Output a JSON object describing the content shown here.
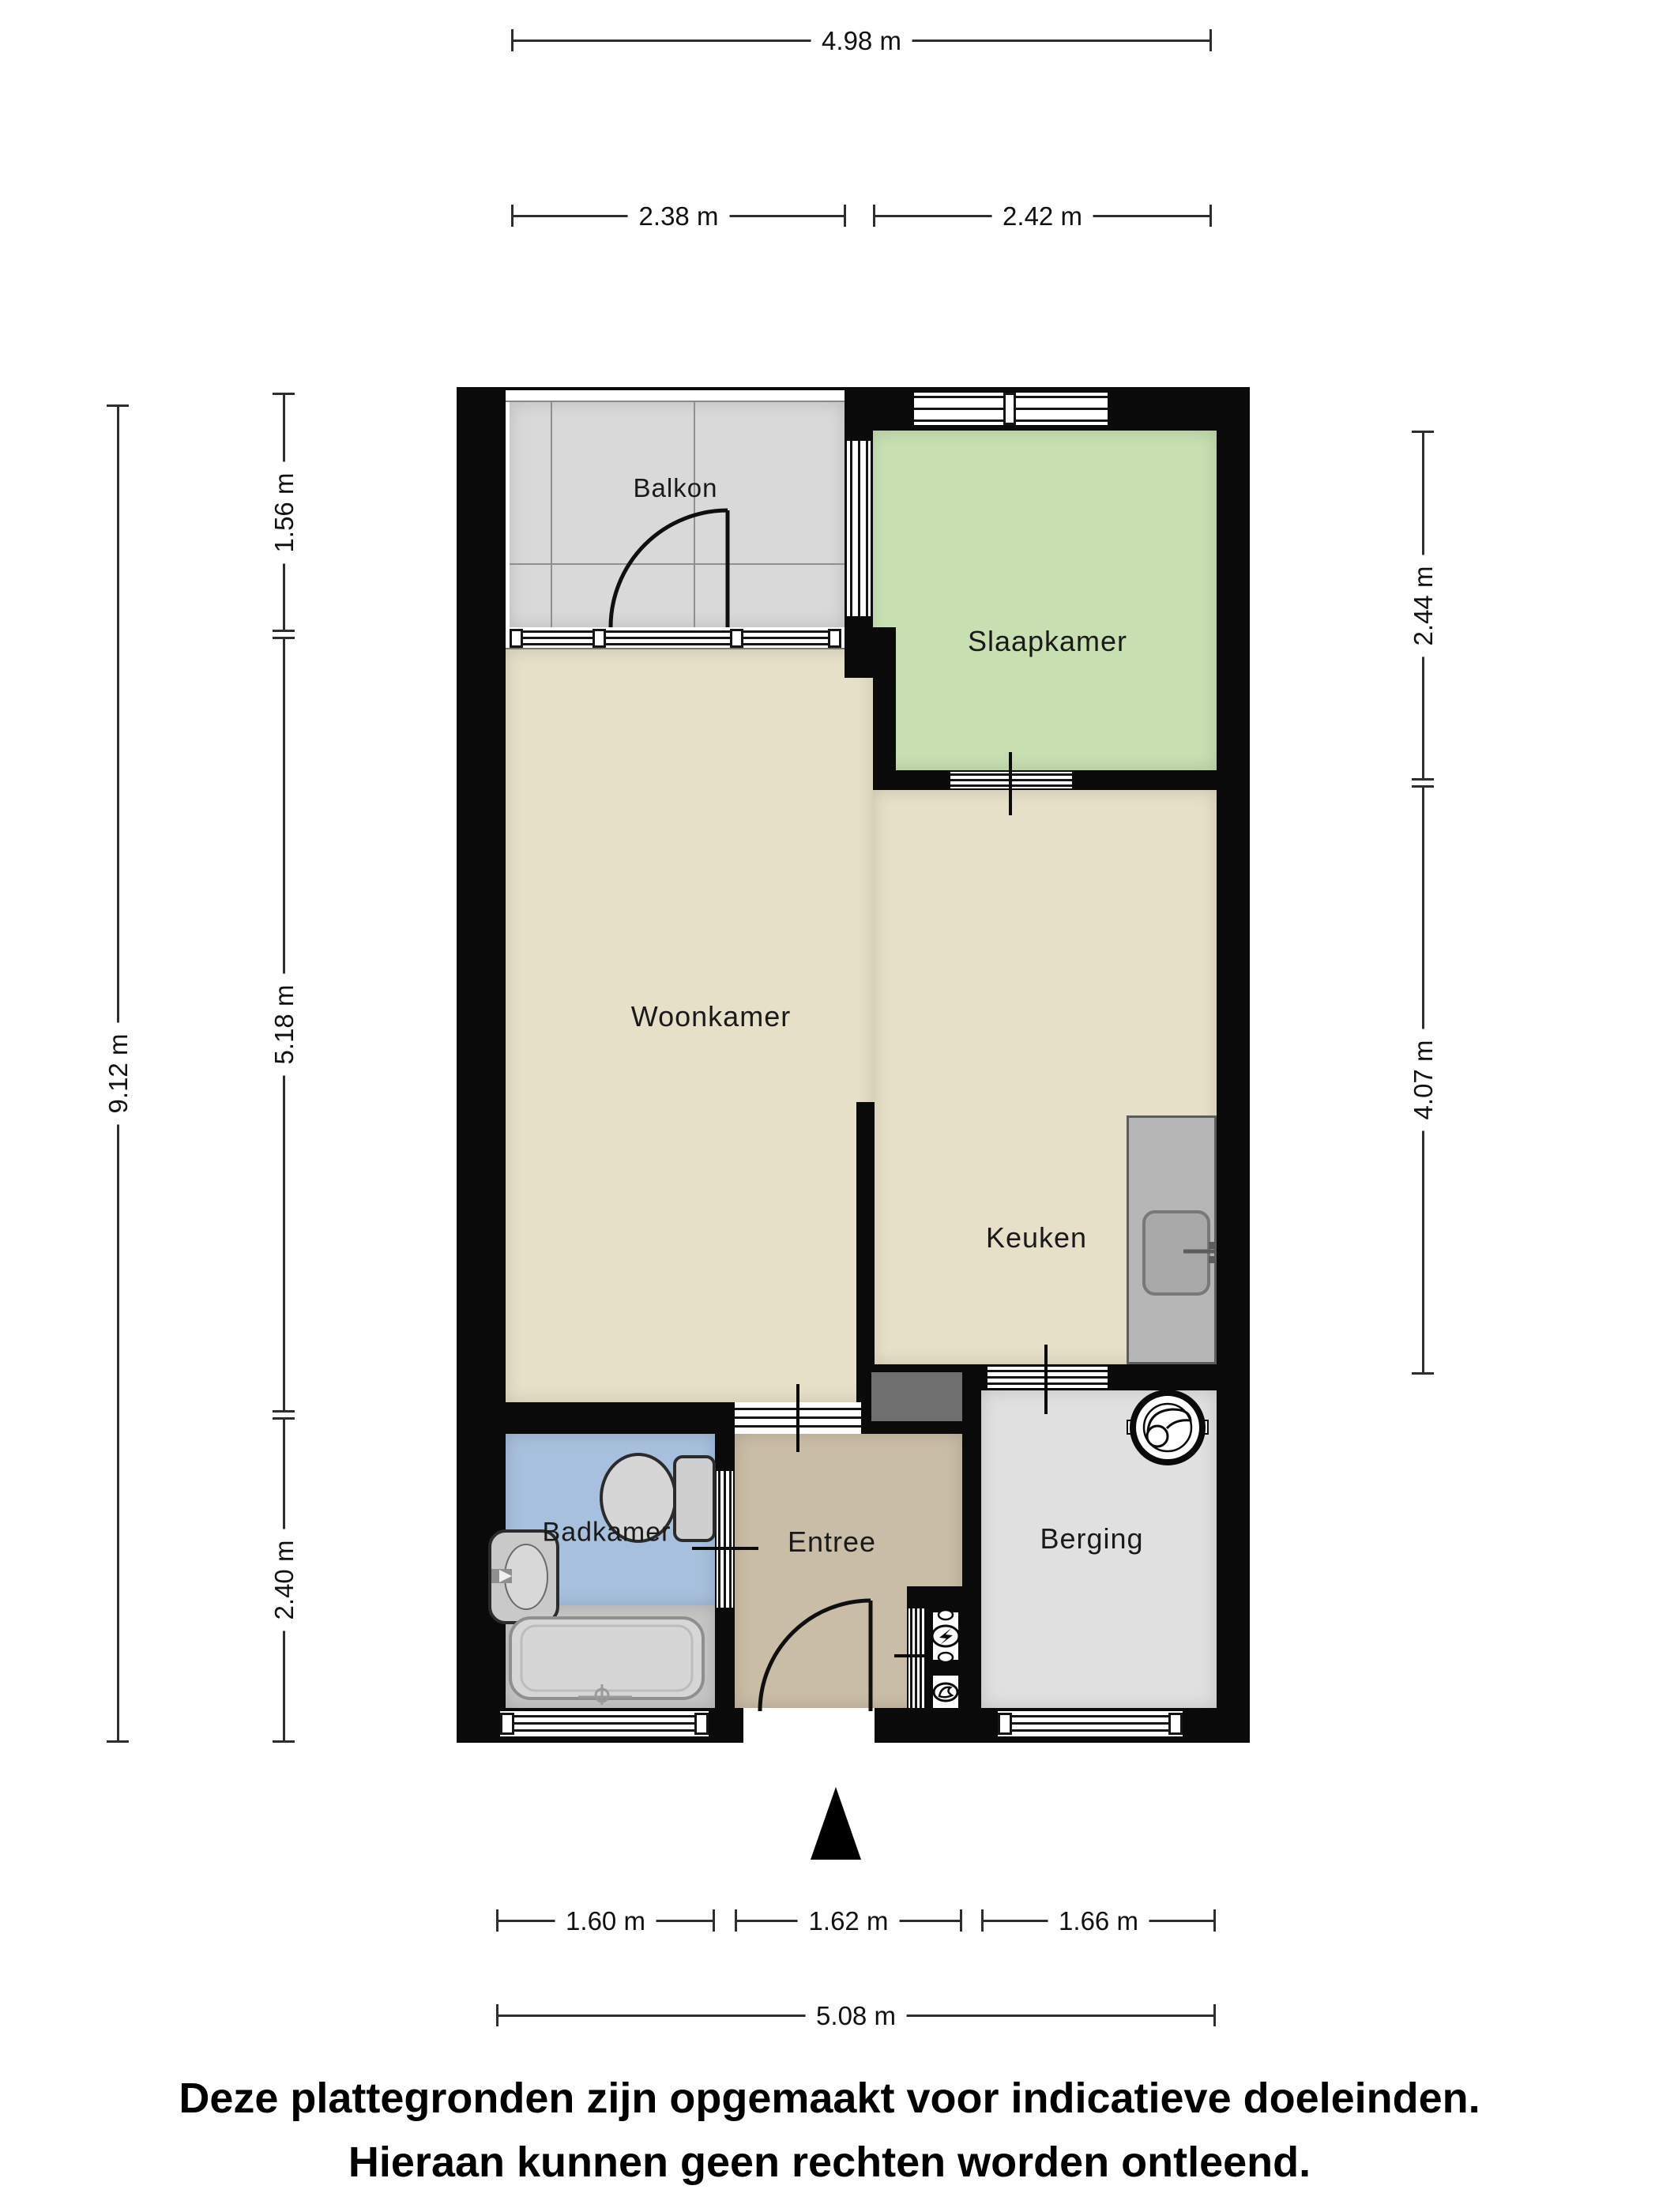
{
  "rooms": {
    "balkon": "Balkon",
    "slaapkamer": "Slaapkamer",
    "woonkamer": "Woonkamer",
    "keuken": "Keuken",
    "badkamer": "Badkamer",
    "entree": "Entree",
    "berging": "Berging"
  },
  "dimensions": {
    "top_total": "4.98 m",
    "top_left": "2.38 m",
    "top_right": "2.42 m",
    "left_total": "9.12 m",
    "left_top": "1.56 m",
    "left_mid": "5.18 m",
    "left_bottom": "2.40 m",
    "right_top": "2.44 m",
    "right_bottom": "4.07 m",
    "bottom_left": "1.60 m",
    "bottom_mid": "1.62 m",
    "bottom_right": "1.66 m",
    "bottom_total": "5.08 m"
  },
  "footer": {
    "line1": "Deze plattegronden zijn opgemaakt voor indicatieve doeleinden.",
    "line2": "Hieraan kunnen geen rechten worden ontleend."
  },
  "colors": {
    "wall": "#0a0a0a",
    "balkon": "#d9d9d9",
    "slaapkamer": "#c7dfb1",
    "woonkamer": "#e7e0c8",
    "keuken": "#e7e0c8",
    "entree": "#cabda7",
    "badkamer": "#a7c0dd",
    "berging": "#e0e0e0",
    "bath_zone": "#c6c6c6",
    "counter": "#b6b6b6",
    "meter_niche": "#6f6f6f"
  },
  "icons": {
    "north_arrow": "north-arrow-icon",
    "washing_machine": "washing-machine-icon",
    "toilet": "toilet-icon",
    "sink": "sink-icon",
    "bathtub": "bathtub-icon",
    "kitchen_sink": "kitchen-sink-icon",
    "electricity_meter": "electricity-meter-icon",
    "gas_meter": "gas-meter-icon"
  }
}
